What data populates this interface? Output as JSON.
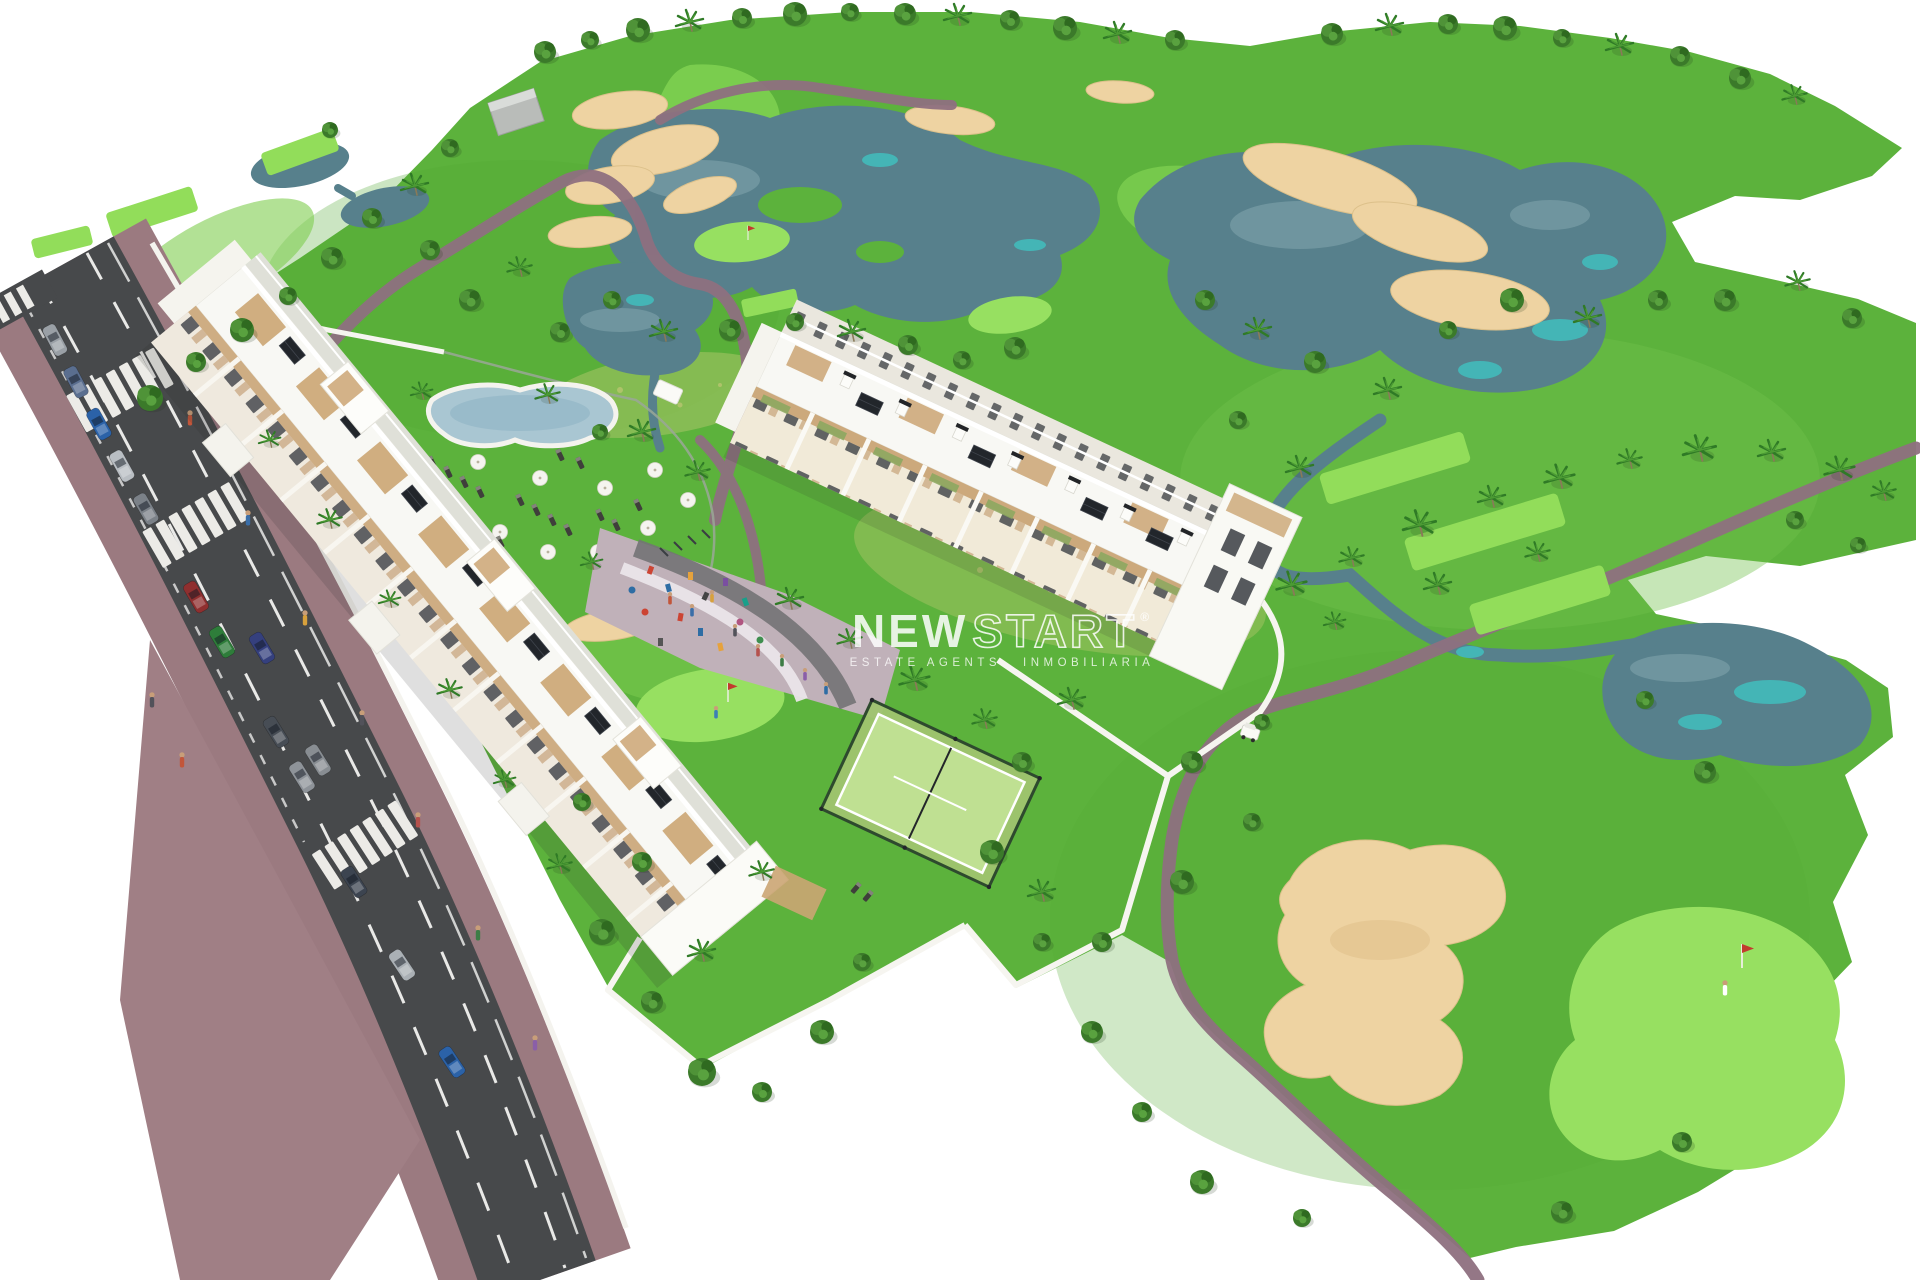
{
  "watermark": {
    "brand_bold": "NEW",
    "brand_outline": "START",
    "registered_mark": "®",
    "tagline_left": "ESTATE AGENTS",
    "tagline_right": "INMOBILIARIA"
  },
  "scene": {
    "type": "aerial-3d-architectural-render",
    "subject": "new-build golf resort apartment complex beside a golf course",
    "features": [
      "golf-course-fairways",
      "lakes-and-streams",
      "sand-bunkers",
      "cart-paths",
      "tee-boxes",
      "putting-green-with-flag",
      "apartment-block-west",
      "apartment-block-east",
      "rooftop-terraces",
      "solar-panels",
      "swimming-pool-with-sun-loungers",
      "parasols",
      "playground-outdoor-gym",
      "padel-court",
      "perimeter-walls",
      "street-with-parked-cars",
      "zebra-crossings",
      "palm-trees",
      "golf-buggy",
      "golfer"
    ],
    "palette": {
      "background": "#ffffff",
      "grass": "#5cb23c",
      "fairway_light": "#82d352",
      "tee_green": "#92dd5a",
      "water": "#57808c",
      "water_teal": "#3ec7c4",
      "sand": "#eed3a2",
      "cart_path": "#8e7080",
      "asphalt": "#47494b",
      "sidewalk": "#9b7a80",
      "building_white": "#f8f8f4",
      "wood_trim": "#c59d6c",
      "solar_panel": "#22262b",
      "padel_court": "#bfe092",
      "paving": "#c0b1b9"
    }
  }
}
